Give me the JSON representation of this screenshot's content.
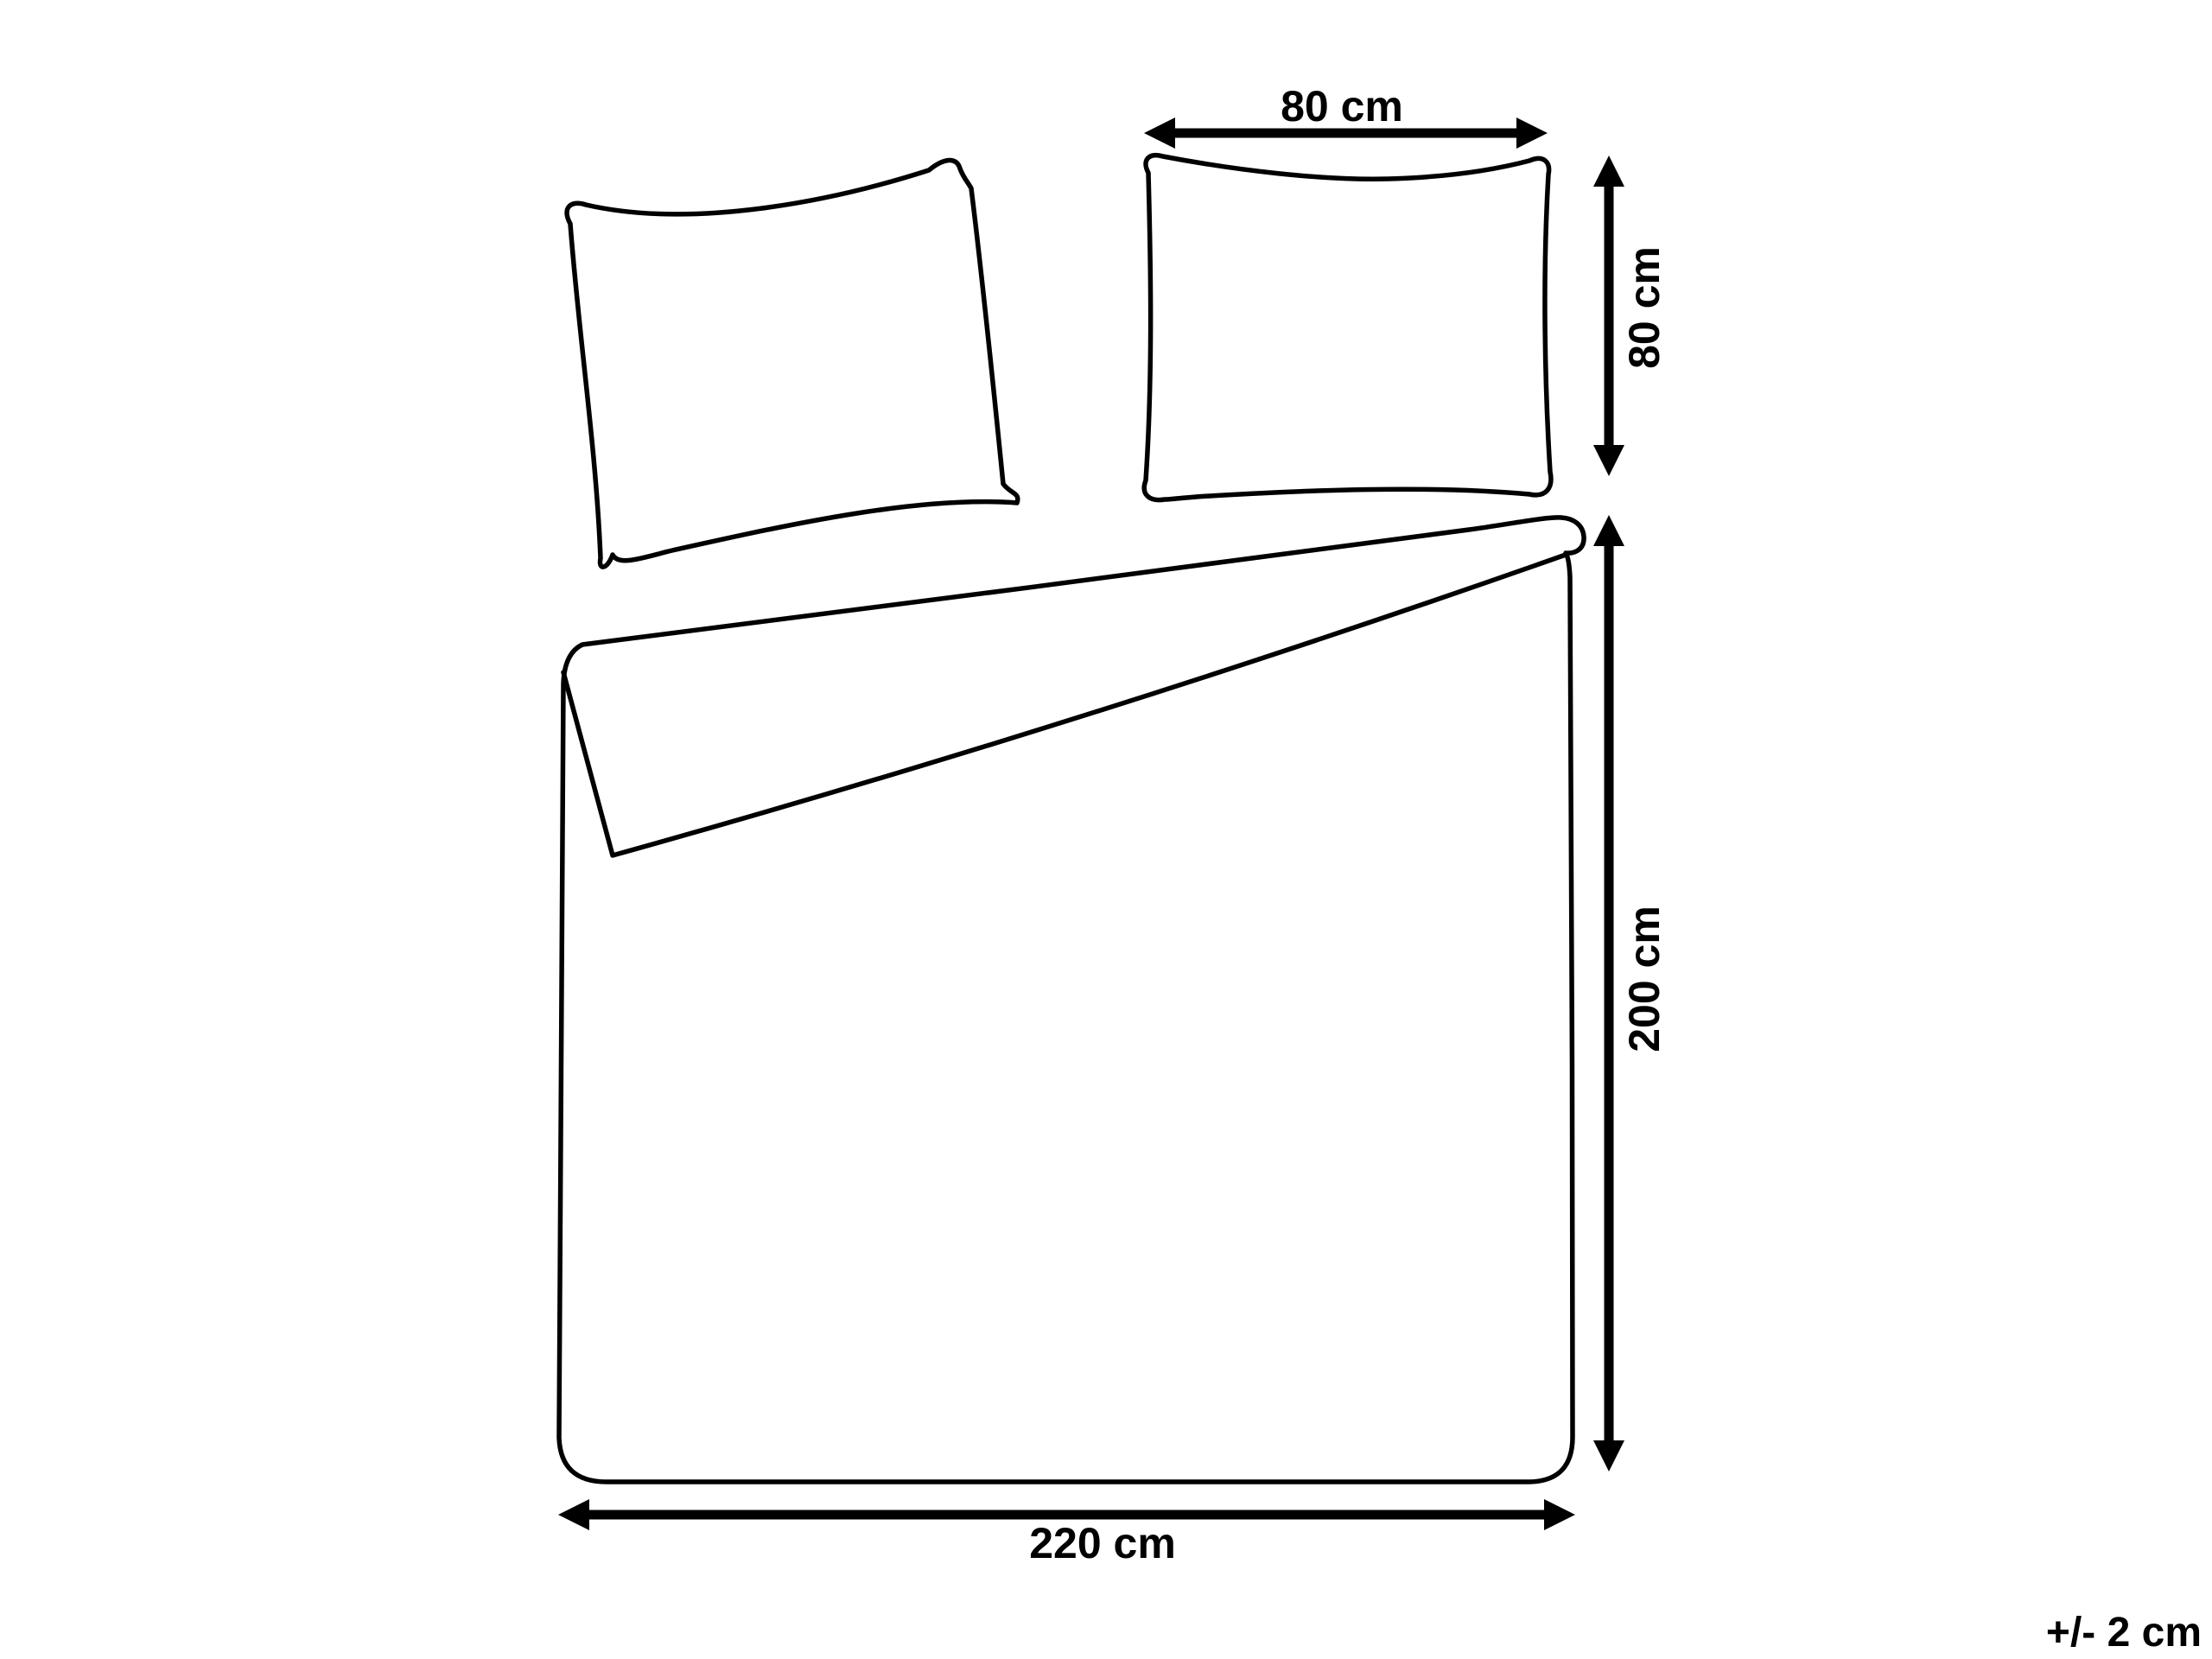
{
  "colors": {
    "background": "#ffffff",
    "line": "#000000",
    "text": "#000000"
  },
  "diagram": {
    "dimensions": {
      "pillow_width": {
        "label": "80 cm"
      },
      "pillow_height": {
        "label": "80 cm"
      },
      "duvet_length": {
        "label": "200 cm"
      },
      "duvet_width": {
        "label": "220 cm"
      }
    },
    "tolerance": {
      "label": "+/- 2 cm"
    }
  }
}
